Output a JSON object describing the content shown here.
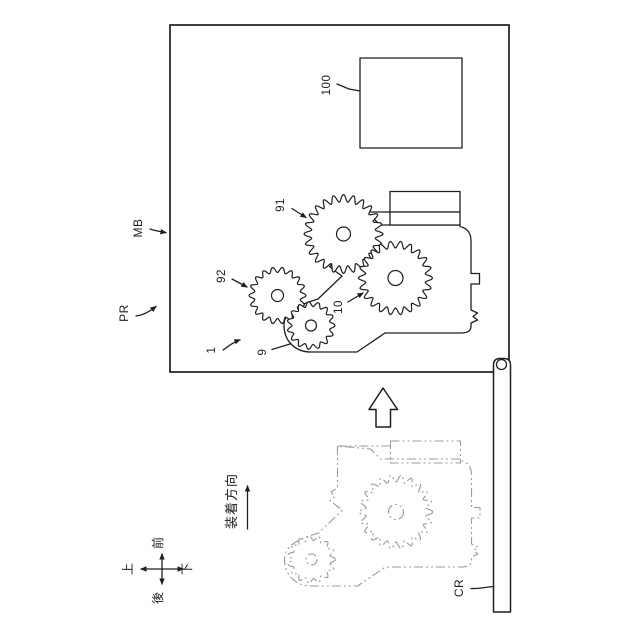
{
  "figure": {
    "labels": {
      "main_body": "MB",
      "printer": "PR",
      "carriage": "CR",
      "unit": "1",
      "gear_train_large": "91",
      "gear_small_upper": "92",
      "gear_input": "10",
      "gear_small_lower": "9",
      "board": "100"
    },
    "mounting_direction": "装着方向",
    "compass": {
      "front": "前",
      "back": "後",
      "up": "上",
      "down": "下"
    },
    "colors": {
      "line": "#1f1f1f",
      "phantom": "#9b9b9b",
      "background": "#ffffff"
    }
  }
}
